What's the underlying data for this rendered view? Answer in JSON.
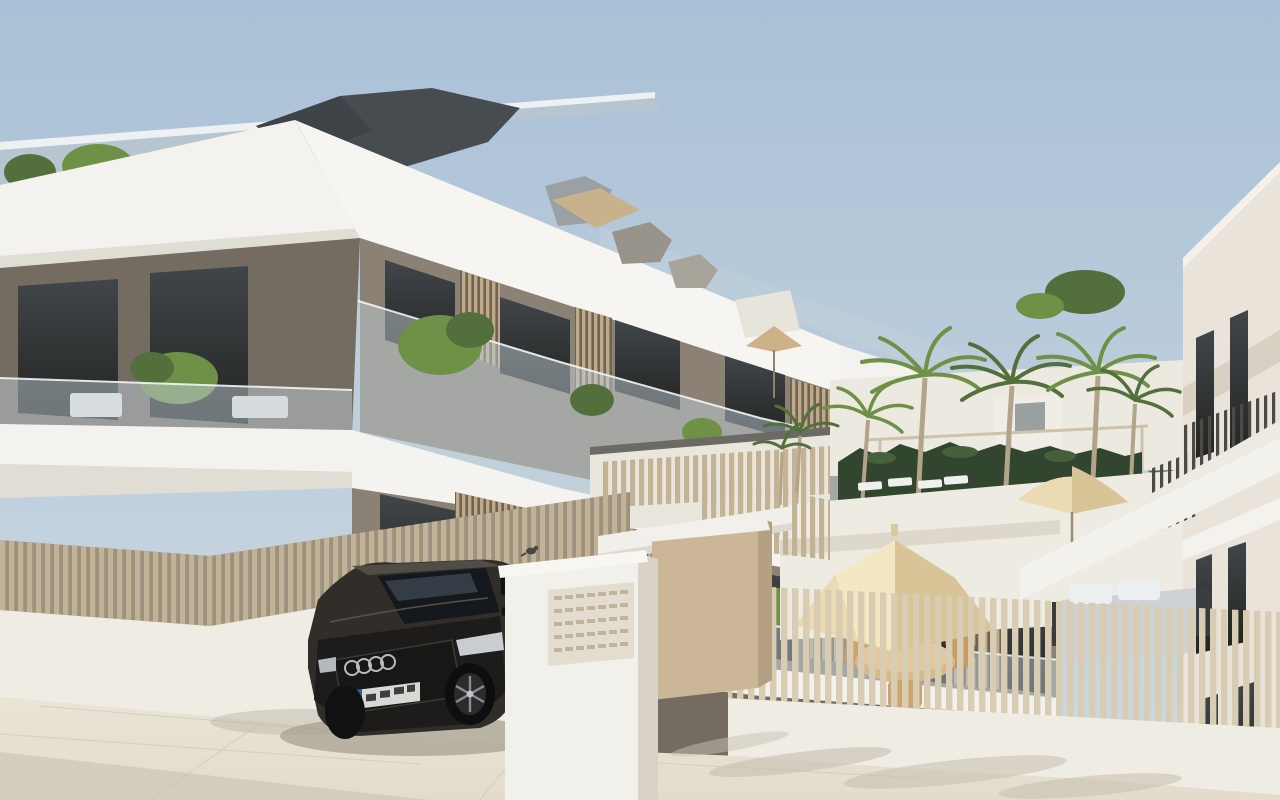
{
  "scene": {
    "type": "3d-architectural-exterior-render",
    "setting": "Modern three-storey white apartment complex with communal pool terrace, palm trees and a dark SUV parked by the entrance on a paved street",
    "time_of_day": "daytime, clear sunny sky",
    "visible_text": "none (license plate characters are blurred and not legible)"
  },
  "objects": {
    "main_building": "white flat-roof apartment block, taupe walls, glass balcony balustrades, wooden louver privacy screens, rooftop terrace with shrubs and dark grey roof volume",
    "right_building": "white apartment wing with tall dark window strips, external staircase and sloping walkway with slatted railing",
    "car": "dark grey Audi SUV with four-ring grille badge and blurred EU license plate",
    "entrance": "white mailbox pillar with grid of letterbox slots, beige gate pillars with white caps and white lintel beam",
    "fences": "vertical wooden-slat fences on white base walls enclosing ground-floor terraces and pool area",
    "pool_area": "cream parasols, round wooden dining table with chairs, grey outdoor sofa with white cushions, white sun loungers, dark green hedge, beige pergola frame",
    "palm_count": 7,
    "bird": "small bird perched on the entrance wall",
    "shadows": "car shadow on pavement, palm frond shadows at lower right"
  },
  "colors": {
    "sky_top": "#a9c0d6",
    "sky_bottom": "#cfdae2",
    "roof_plane": "#b7c5d1",
    "roof_dark": "#474c50",
    "white": "#f3f2ee",
    "white_shade": "#e0ddd4",
    "wall": "#8b8174",
    "wall_dark": "#746c60",
    "window": "#2e2f2e",
    "glass": "#c3d2da",
    "fence": "#c3b294",
    "fence_light": "#d8ccb2",
    "louver": "#bfa987",
    "base_wall": "#efece4",
    "ground": "#e3dccc",
    "ground_dark": "#d5cdbc",
    "hedge": "#31452f",
    "palm": "#6f9147",
    "palm_dark": "#53703c",
    "trunk": "#b3a489",
    "umbrella": "#ecdbb2",
    "umbrella_shade": "#d9c497",
    "car_body": "#312e2a",
    "car_dark": "#1d1c1a",
    "right_building": "#e9e3da",
    "step_grey": "#bcb9b1"
  }
}
